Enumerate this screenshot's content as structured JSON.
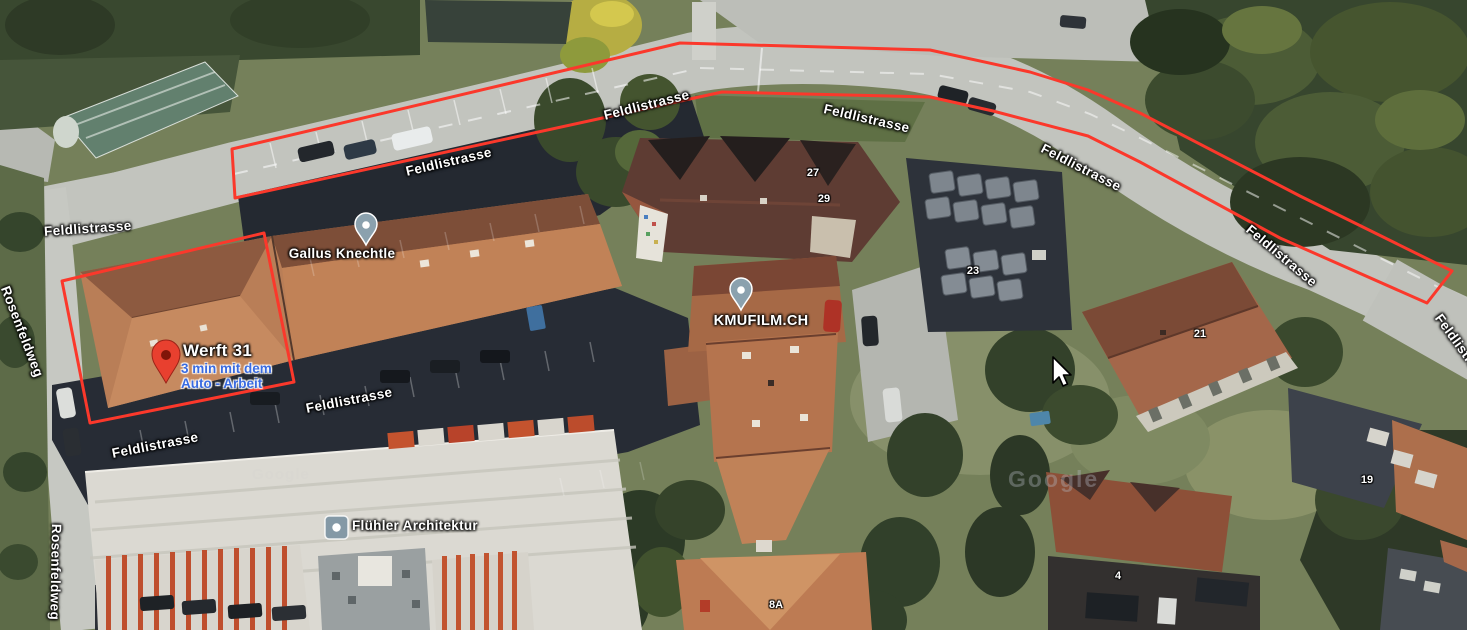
{
  "map": {
    "view": "satellite",
    "streets": {
      "feldlistrasse": "Feldlistrasse",
      "rosenfeldweg": "Rosenfeldweg"
    },
    "house_numbers": {
      "n27": "27",
      "n29": "29",
      "n23": "23",
      "n21": "21",
      "n19": "19",
      "n4": "4",
      "n8a": "8A"
    },
    "places": {
      "werft31": {
        "name": "Werft 31",
        "travel_time_line1": "3 min mit dem",
        "travel_time_line2": "Auto - Arbeit",
        "pin": "red-destination-pin"
      },
      "gallus": {
        "name": "Gallus Knechtle",
        "pin": "grey-business-pin"
      },
      "kmufilm": {
        "name": "KMUFILM.CH",
        "pin": "grey-business-pin"
      },
      "fluehler": {
        "name": "Flühler Architektur",
        "pin": "grey-square-business-icon"
      }
    },
    "watermark": {
      "google": "Google"
    },
    "annotations": {
      "color": "#fb382b",
      "shapes": [
        "street-outline-polygon",
        "building-outline-rectangle"
      ]
    },
    "colors": {
      "annotation_red": "#fb382b",
      "travel_time_blue": "#3a6be0",
      "destination_pin_red": "#e8402f",
      "business_pin_grey": "#8ba1ae"
    }
  }
}
